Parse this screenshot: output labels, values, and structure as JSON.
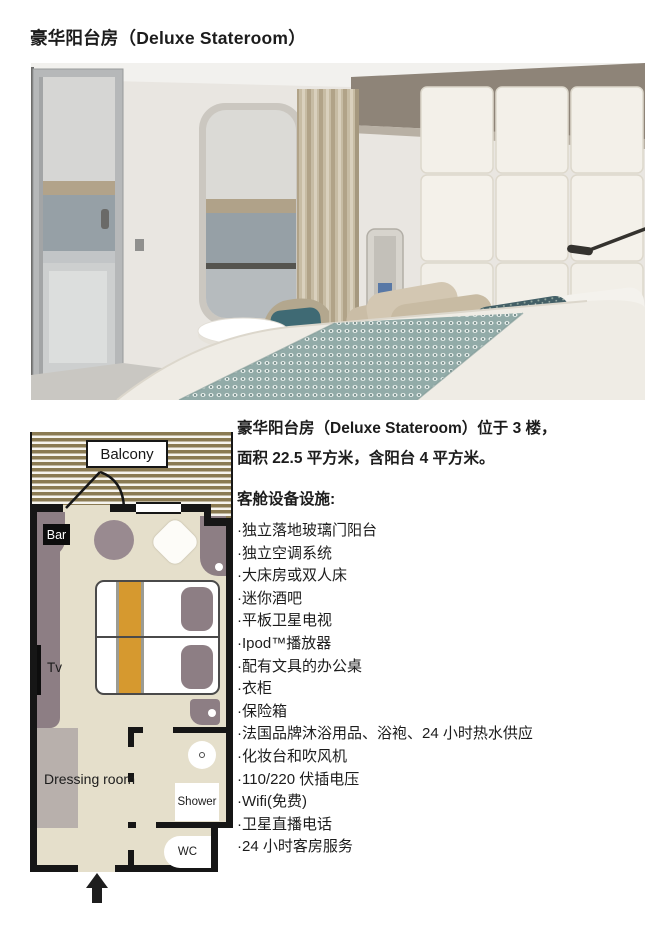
{
  "title": "豪华阳台房（Deluxe Stateroom）",
  "floorplan": {
    "balcony_label": "Balcony",
    "bar_label": "Bar",
    "tv_label": "Tv",
    "dressing_room_label": "Dressing room",
    "shower_label": "Shower",
    "wc_label": "WC"
  },
  "description": {
    "line1": "豪华阳台房（Deluxe Stateroom）位于 3 楼，",
    "line2": "面积 22.5 平方米，含阳台 4 平方米。",
    "heading": "客舱设备设施:",
    "items": [
      "·独立落地玻璃门阳台",
      "·独立空调系统",
      "·大床房或双人床",
      "·迷你酒吧",
      "·平板卫星电视",
      "·Ipod™播放器",
      "·配有文具的办公桌",
      "·衣柜",
      "·保险箱",
      "·法国品牌沐浴用品、浴袍、24 小时热水供应",
      "·化妆台和吹风机",
      "·110/220 伏插电压",
      "·Wifi(免费)",
      "·卫星直播电话",
      "·24 小时客房服务"
    ]
  },
  "colors": {
    "accent_orange": "#d6992f",
    "furniture_mauve": "#8d7e84",
    "floor_beige": "#e5dfcb",
    "balcony_stripe_brown": "#8a7a52",
    "wall_black": "#161616",
    "dressing_gray": "#b8b0ac"
  }
}
